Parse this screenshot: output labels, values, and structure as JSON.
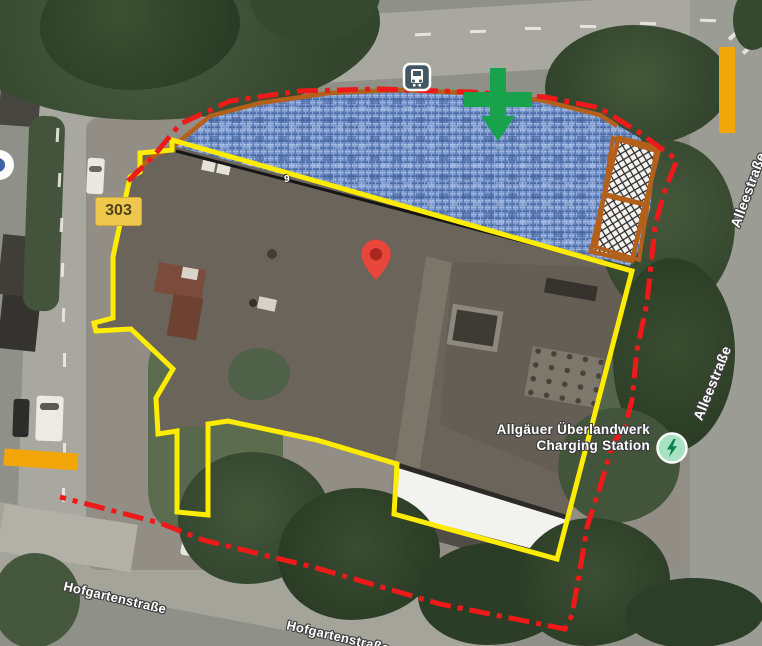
{
  "map": {
    "streets": {
      "alleestrasse_upper": "Alleestraße",
      "alleestrasse_lower": "Alleestraße",
      "hofgartenstrasse_west": "Hofgartenstraße",
      "hofgartenstrasse_south": "Hofgartenstraße"
    },
    "route_badge": "303",
    "house_number": "9",
    "poi": {
      "name_line1": "Allgäuer Überlandwerk",
      "name_line2": "Charging Station"
    },
    "icons": {
      "bus_stop": "bus-in-rounded-square",
      "ev_charging": "lightning-bolt-in-green-circle",
      "location_pin": "red-teardrop-pin",
      "direction_marker": "green-cross-with-down-arrow"
    },
    "colors": {
      "parcel_outline": "#ffec00",
      "boundary_dashdot": "#ee1a1a",
      "edge_line": "#b4601a",
      "hatched_area_fill": "#7b98cf",
      "highlight_bars": "#f2a60a",
      "direction_marker": "#18a24b",
      "pin": "#e8463a",
      "charging_badge": "#a7e3c3"
    }
  }
}
